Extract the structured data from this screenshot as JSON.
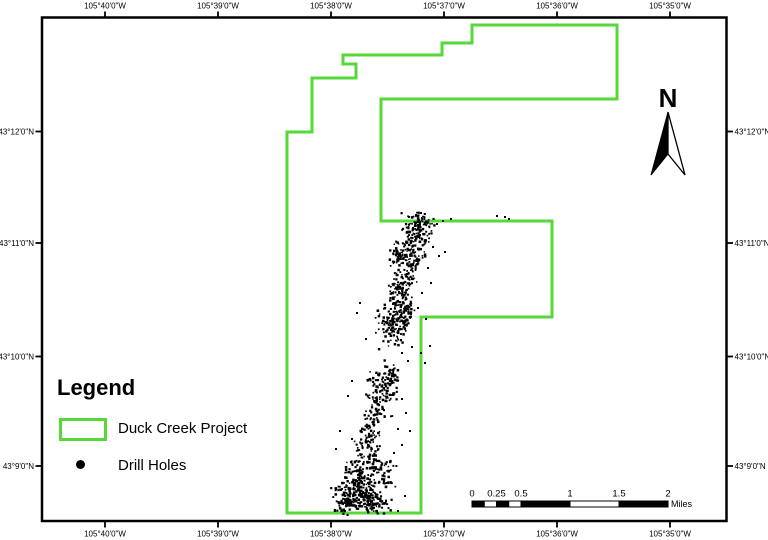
{
  "page": {
    "background": "#ffffff"
  },
  "map_frame": {
    "x": 42,
    "y": 17.5,
    "width": 684.5,
    "height": 503.5,
    "stroke": "#000000"
  },
  "graticule": {
    "top": {
      "labels": [
        "105°40'0\"W",
        "105°39'0\"W",
        "105°38'0\"W",
        "105°37'0\"W",
        "105°36'0\"W",
        "105°35'0\"W"
      ],
      "x": [
        105,
        218,
        331,
        444,
        557,
        670
      ]
    },
    "bottom": {
      "labels": [
        "105°40'0\"W",
        "105°39'0\"W",
        "105°38'0\"W",
        "105°37'0\"W",
        "105°36'0\"W",
        "105°35'0\"W"
      ],
      "x": [
        105,
        218,
        331,
        444,
        557,
        670
      ]
    },
    "left": {
      "labels": [
        "43°12'0\"N",
        "43°11'0\"N",
        "43°10'0\"N",
        "43°9'0\"N"
      ],
      "y": [
        131.5,
        243,
        356.5,
        466
      ]
    },
    "right": {
      "labels": [
        "43°12'0\"N",
        "43°11'0\"N",
        "43°10'0\"N",
        "43°9'0\"N"
      ],
      "y": [
        131.5,
        243,
        356.5,
        466
      ]
    }
  },
  "project_boundary": {
    "label": "Duck Creek Project",
    "color": "#55d838",
    "stroke_width": 3,
    "points": [
      [
        343,
        55
      ],
      [
        442,
        55
      ],
      [
        442,
        43
      ],
      [
        472,
        43
      ],
      [
        472,
        25
      ],
      [
        617,
        25
      ],
      [
        617,
        99
      ],
      [
        381,
        99
      ],
      [
        381,
        221
      ],
      [
        552,
        221
      ],
      [
        552,
        317
      ],
      [
        421,
        317
      ],
      [
        421,
        513
      ],
      [
        287,
        513
      ],
      [
        287,
        132
      ],
      [
        312,
        132
      ],
      [
        312,
        78
      ],
      [
        356,
        78
      ],
      [
        356,
        64
      ],
      [
        343,
        64
      ]
    ]
  },
  "drill_holes": {
    "label": "Drill Holes",
    "color": "#000000",
    "seed": 20,
    "clusters": [
      [
        417,
        230,
        7,
        9,
        100
      ],
      [
        424,
        221,
        5,
        3,
        25
      ],
      [
        412,
        255,
        6,
        9,
        75
      ],
      [
        398,
        257,
        4,
        8,
        50
      ],
      [
        407,
        280,
        5,
        9,
        60
      ],
      [
        396,
        292,
        4,
        9,
        55
      ],
      [
        404,
        307,
        5,
        7,
        45
      ],
      [
        391,
        326,
        7,
        11,
        110
      ],
      [
        403,
        318,
        5,
        6,
        35
      ],
      [
        392,
        373,
        5,
        6,
        30
      ],
      [
        383,
        390,
        8,
        13,
        110
      ],
      [
        373,
        420,
        6,
        9,
        50
      ],
      [
        368,
        444,
        7,
        9,
        65
      ],
      [
        364,
        471,
        10,
        8,
        120
      ],
      [
        385,
        474,
        6,
        7,
        40
      ],
      [
        357,
        492,
        12,
        7,
        160
      ],
      [
        372,
        503,
        9,
        5,
        90
      ],
      [
        345,
        505,
        6,
        5,
        60
      ]
    ],
    "outliers": [
      [
        437,
        224
      ],
      [
        443,
        221
      ],
      [
        451,
        219
      ],
      [
        445,
        252
      ],
      [
        439,
        256
      ],
      [
        433,
        247
      ],
      [
        428,
        268
      ],
      [
        431,
        283
      ],
      [
        422,
        293
      ],
      [
        418,
        308
      ],
      [
        426,
        319
      ],
      [
        430,
        346
      ],
      [
        421,
        353
      ],
      [
        425,
        363
      ],
      [
        412,
        347
      ],
      [
        408,
        361
      ],
      [
        402,
        353
      ],
      [
        360,
        303
      ],
      [
        357,
        313
      ],
      [
        366,
        339
      ],
      [
        352,
        381
      ],
      [
        348,
        396
      ],
      [
        402,
        399
      ],
      [
        406,
        413
      ],
      [
        398,
        429
      ],
      [
        402,
        445
      ],
      [
        394,
        453
      ],
      [
        410,
        431
      ],
      [
        340,
        431
      ],
      [
        336,
        449
      ],
      [
        398,
        511
      ],
      [
        405,
        496
      ],
      [
        352,
        439
      ],
      [
        505,
        217
      ],
      [
        509,
        219
      ],
      [
        497,
        216
      ],
      [
        416,
        215
      ],
      [
        409,
        217
      ],
      [
        421,
        213
      ]
    ]
  },
  "north_arrow": {
    "label": "N",
    "apex": [
      668,
      112
    ],
    "left_tip": [
      651,
      175
    ],
    "right_tip": [
      685,
      175
    ],
    "notch": [
      668,
      154
    ]
  },
  "scale_bar": {
    "unit": "Miles",
    "x": 472,
    "y": 501,
    "height": 6,
    "px_per_mile": 98,
    "tick_labels": [
      "0",
      "0.25",
      "0.5",
      "1",
      "1.5",
      "2"
    ],
    "tick_miles": [
      0,
      0.25,
      0.5,
      1,
      1.5,
      2
    ],
    "black_segments": [
      [
        0,
        0.125
      ],
      [
        0.25,
        0.375
      ],
      [
        0.5,
        1
      ],
      [
        1.5,
        2
      ]
    ],
    "dividers": [
      0.125,
      0.25,
      0.375,
      0.5,
      1,
      1.5
    ]
  },
  "legend": {
    "title": "Legend",
    "items": [
      {
        "label": "Duck Creek Project",
        "swatch": "rect-outline"
      },
      {
        "label": "Drill Holes",
        "swatch": "dot"
      }
    ]
  }
}
